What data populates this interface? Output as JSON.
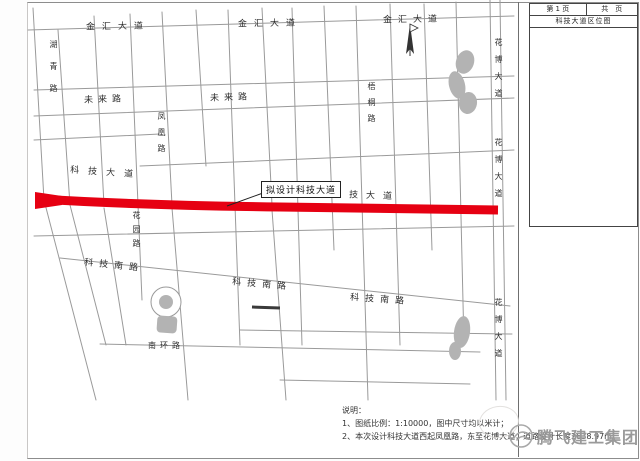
{
  "sheet": {
    "page_label": "第 1 页",
    "total_label": "共　页",
    "title": "科技大道区位图"
  },
  "map": {
    "proposed_road_box": "拟设计科技大道",
    "road_labels": [
      {
        "id": "jinhui-west",
        "text": "金汇大道"
      },
      {
        "id": "jinhui-mid",
        "text": "金汇大道"
      },
      {
        "id": "jinhui-east",
        "text": "金汇大道"
      },
      {
        "id": "huqing",
        "text": "湖青路"
      },
      {
        "id": "weilai-west",
        "text": "未来路"
      },
      {
        "id": "weilai-mid",
        "text": "未来路"
      },
      {
        "id": "fenghuang",
        "text": "凤凰路"
      },
      {
        "id": "wutong",
        "text": "梧桐路"
      },
      {
        "id": "keji-west",
        "text": "科技大道"
      },
      {
        "id": "keji-east",
        "text": "科技大道"
      },
      {
        "id": "huayuan",
        "text": "花园路"
      },
      {
        "id": "kejinan-west",
        "text": "科技南路"
      },
      {
        "id": "kejinan-mid",
        "text": "科技南路"
      },
      {
        "id": "kejinan-east",
        "text": "科技南路"
      },
      {
        "id": "nanhuan",
        "text": "南环路"
      },
      {
        "id": "huabo-top",
        "text": "花博大道"
      },
      {
        "id": "huabo-mid",
        "text": "花博大道"
      },
      {
        "id": "huabo-bot",
        "text": "花博大道"
      }
    ],
    "highlight_color": "#e60012",
    "pond_color": "#b3b3b3",
    "grid_line_color": "#9a9a9a"
  },
  "notes": {
    "heading": "说明：",
    "line1": "1、图纸比例：1:10000，图中尺寸均以米计；",
    "line2": "2、本次设计科技大道西起凤凰路，东至花博大道，道路设计长度2638.97m。"
  },
  "watermark": {
    "company": "腾飞建工集团"
  }
}
